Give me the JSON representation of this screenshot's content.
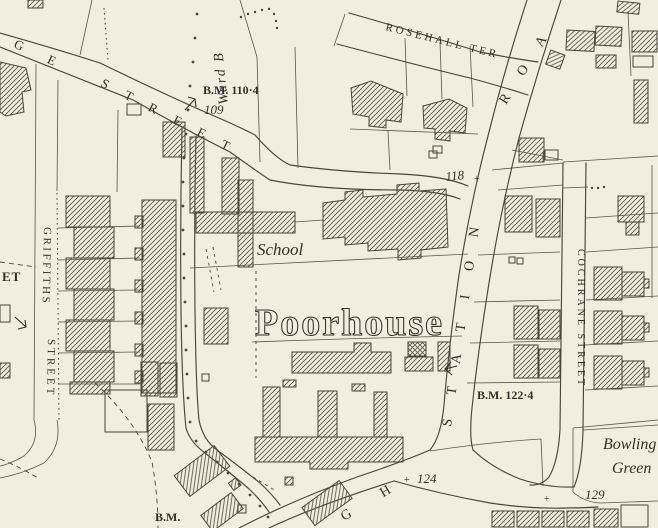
{
  "colors": {
    "paper": "#f2edde",
    "ink": "#4a443a",
    "text": "#33302a",
    "hatch": "#5d5648"
  },
  "labels": {
    "ge": "G E",
    "street_upper": "STREET",
    "ward": "Ward B",
    "bm110": "B.M. 110·4",
    "n109": "109",
    "rosehall": "ROSEHALL TER",
    "n118": "118",
    "school": "School",
    "poorhouse": "Poorhouse",
    "station": "STATION",
    "road": "ROA",
    "cochrane": "COCHRANE STREET",
    "bm122": "B.M. 122·4",
    "n124": "124",
    "n129": "129",
    "bowling_line1": "Bowling",
    "bowling_line2": "Green",
    "high": "G H",
    "bm_bottom": "B.M.",
    "et": "ET",
    "griffiths": "GRIFFITHS",
    "griffiths_street": "STREET",
    "cross": "+"
  }
}
